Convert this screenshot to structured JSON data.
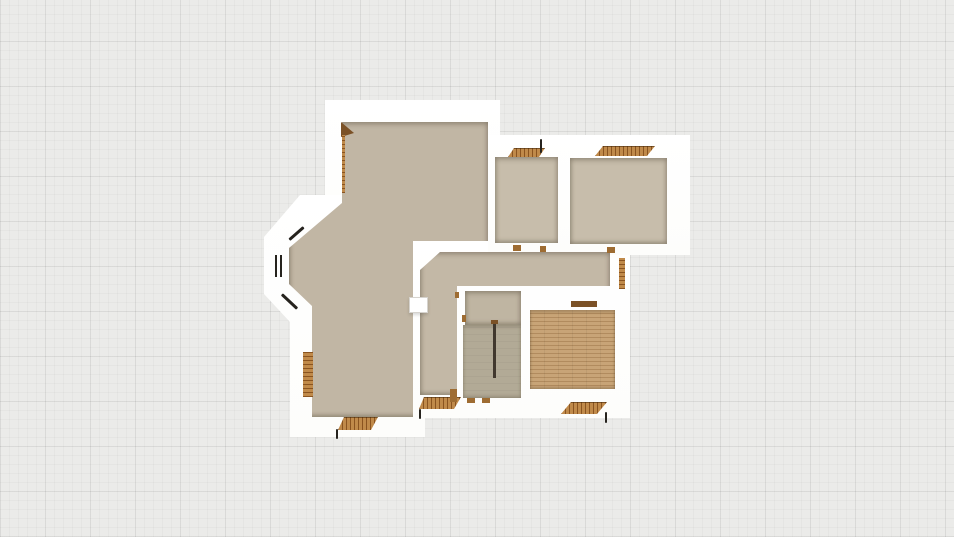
{
  "palette": {
    "bg": "#ebebe9",
    "gridMinor": "rgba(0,0,0,0.028)",
    "gridMajor": "rgba(0,0,0,0.05)",
    "wall": "#ffffff",
    "floorMain": "#c1b6a4",
    "floorRooms": "#c7bdab",
    "floorHall": "#c3b8a6",
    "stairUp": "#bfb5a2",
    "stairLow": "#b2aa96",
    "woodBase": "#c8a477",
    "woodLine": "#b18b5e",
    "thDark": "#8a5420",
    "thLight": "#c08a4a",
    "thMid": "#9e6c32",
    "thDeep": "#7b5126",
    "windowLine": "#26231e",
    "rail": "#41382e",
    "doorBorder": "#d6d3ce"
  },
  "elements": [
    {
      "name": "wall-block-top-left",
      "kind": "wall",
      "x": 325,
      "y": 100,
      "w": 175,
      "h": 150
    },
    {
      "name": "wall-block-bay-left",
      "kind": "wall",
      "x": 264,
      "y": 195,
      "w": 161,
      "h": 242,
      "clip": "polygon(84px 0px, 36px 0px, 0px 42px, 0px 99px, 26px 127px, 26px 242px, 161px 242px, 161px 0px)"
    },
    {
      "name": "wall-block-center",
      "kind": "wall",
      "x": 408,
      "y": 238,
      "w": 222,
      "h": 180
    },
    {
      "name": "wall-block-top-right",
      "kind": "wall",
      "x": 488,
      "y": 135,
      "w": 202,
      "h": 120
    },
    {
      "name": "floor-living-area",
      "kind": "floor",
      "fill": "floorMain",
      "x": 289,
      "y": 122,
      "w": 199,
      "h": 295,
      "clip": "polygon(53px 0px, 199px 0px, 199px 119px, 124px 119px, 124px 295px, 23px 295px, 23px 184px, 0px 162px, 0px 126px, 53px 81px)"
    },
    {
      "name": "floor-hallway",
      "kind": "floor",
      "fill": "floorHall",
      "x": 420,
      "y": 252,
      "w": 190,
      "h": 143,
      "clip": "polygon(20px 0px, 190px 0px, 190px 34px, 37px 34px, 37px 143px, 0px 143px, 0px 18px)"
    },
    {
      "name": "floor-room-top-a",
      "kind": "floor",
      "fill": "floorRooms",
      "x": 495,
      "y": 157,
      "w": 63,
      "h": 86
    },
    {
      "name": "floor-room-top-b",
      "kind": "floor",
      "fill": "floorRooms",
      "x": 570,
      "y": 158,
      "w": 97,
      "h": 86
    },
    {
      "name": "floor-stair-upper",
      "kind": "floor",
      "fill": "stairUp",
      "x": 465,
      "y": 291,
      "w": 56,
      "h": 34
    },
    {
      "name": "floor-stair-lower",
      "kind": "stair",
      "x": 463,
      "y": 325,
      "w": 58,
      "h": 73
    },
    {
      "name": "floor-wood-room",
      "kind": "wood-floor",
      "x": 530,
      "y": 310,
      "w": 85,
      "h": 79
    },
    {
      "name": "door-leaf-top-room",
      "kind": "wood-dark",
      "x": 341,
      "y": 122,
      "w": 13,
      "h": 15,
      "clip": "polygon(0px 0px, 13px 11px, 0px 15px)"
    },
    {
      "name": "door-edge-top-room",
      "kind": "door-v",
      "x": 342,
      "y": 135,
      "w": 3,
      "h": 58
    },
    {
      "name": "threshold-room-a",
      "kind": "threshold",
      "x": 508,
      "y": 148,
      "w": 37,
      "h": 9,
      "clip": "polygon(6px 0px, 37px 0px, 31px 9px, 0px 9px)"
    },
    {
      "name": "door-swing-room-a",
      "kind": "line-dark",
      "x": 540,
      "y": 139,
      "w": 2,
      "h": 14
    },
    {
      "name": "threshold-room-b",
      "kind": "threshold",
      "x": 595,
      "y": 146,
      "w": 60,
      "h": 10,
      "clip": "polygon(8px 0px, 60px 0px, 52px 10px, 0px 10px)"
    },
    {
      "name": "window-bay-upper",
      "kind": "line-dark",
      "x": 287,
      "y": 232,
      "w": 19,
      "h": 3,
      "rot": -41
    },
    {
      "name": "window-bay-middle",
      "kind": "window-rect",
      "x": 275,
      "y": 255,
      "w": 7,
      "h": 22
    },
    {
      "name": "window-bay-lower",
      "kind": "line-dark",
      "x": 279,
      "y": 300,
      "w": 21,
      "h": 3,
      "rot": 43
    },
    {
      "name": "door-bay-left",
      "kind": "door-v",
      "x": 303,
      "y": 352,
      "w": 10,
      "h": 45
    },
    {
      "name": "threshold-bottom-left",
      "kind": "threshold",
      "x": 338,
      "y": 417,
      "w": 40,
      "h": 13,
      "clip": "polygon(6px 0px, 40px 0px, 33px 13px, 0px 13px)"
    },
    {
      "name": "door-swing-bottom-left",
      "kind": "line-dark",
      "x": 336,
      "y": 429,
      "w": 2,
      "h": 10
    },
    {
      "name": "threshold-hall-south",
      "kind": "threshold",
      "x": 419,
      "y": 397,
      "w": 42,
      "h": 12,
      "clip": "polygon(5px 0px, 42px 0px, 35px 12px, 0px 12px)"
    },
    {
      "name": "door-swing-hall-south",
      "kind": "line-dark",
      "x": 419,
      "y": 409,
      "w": 2,
      "h": 10
    },
    {
      "name": "door-white-open",
      "kind": "door-white",
      "x": 409,
      "y": 297,
      "w": 19,
      "h": 16
    },
    {
      "name": "jamb-room-a-left",
      "kind": "wood-mark",
      "x": 513,
      "y": 245,
      "w": 8,
      "h": 6
    },
    {
      "name": "jamb-room-a-right",
      "kind": "wood-mark",
      "x": 540,
      "y": 246,
      "w": 6,
      "h": 6
    },
    {
      "name": "jamb-hall-east-top",
      "kind": "wood-mark",
      "x": 607,
      "y": 247,
      "w": 8,
      "h": 6
    },
    {
      "name": "door-leaf-hall-east",
      "kind": "door-v",
      "x": 619,
      "y": 258,
      "w": 6,
      "h": 31
    },
    {
      "name": "jamb-stair-left-1",
      "kind": "wood-mark",
      "x": 455,
      "y": 292,
      "w": 4,
      "h": 6
    },
    {
      "name": "jamb-stair-left-2",
      "kind": "wood-mark",
      "x": 462,
      "y": 315,
      "w": 4,
      "h": 7
    },
    {
      "name": "door-stair-left",
      "kind": "wood-mark",
      "x": 450,
      "y": 389,
      "w": 7,
      "h": 13
    },
    {
      "name": "jamb-stair-bottom-1",
      "kind": "wood-mark",
      "x": 467,
      "y": 398,
      "w": 8,
      "h": 5
    },
    {
      "name": "jamb-stair-bottom-2",
      "kind": "wood-mark",
      "x": 482,
      "y": 398,
      "w": 8,
      "h": 5
    },
    {
      "name": "stair-rail",
      "kind": "rail",
      "x": 493,
      "y": 322,
      "w": 3,
      "h": 56
    },
    {
      "name": "stair-rail-cap",
      "kind": "wood-dark",
      "x": 491,
      "y": 320,
      "w": 7,
      "h": 4
    },
    {
      "name": "threshold-wood-room-north",
      "kind": "wood-dark",
      "x": 571,
      "y": 301,
      "w": 26,
      "h": 6
    },
    {
      "name": "threshold-wood-room-south",
      "kind": "threshold",
      "x": 561,
      "y": 402,
      "w": 46,
      "h": 12,
      "clip": "polygon(10px 0px, 46px 0px, 36px 12px, 0px 12px)"
    },
    {
      "name": "door-swing-wood-room",
      "kind": "line-dark",
      "x": 605,
      "y": 412,
      "w": 2,
      "h": 11
    }
  ]
}
